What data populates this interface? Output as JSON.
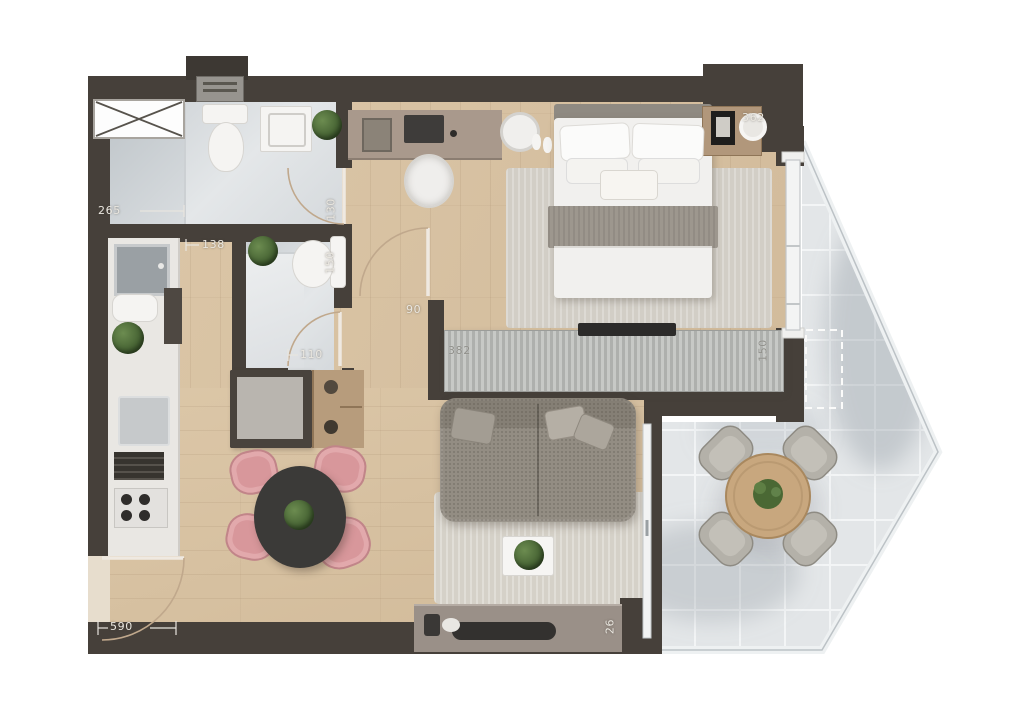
{
  "plan": {
    "dimensions": {
      "bath1_width_cm": "265",
      "bath1_wall_cm": "130",
      "bath2_height_cm": "150",
      "hall_width_cm": "138",
      "bath2_door_cm": "110",
      "bedroom_opening_cm": "90",
      "divider_length_cm": "382",
      "divider_end_cm": "150",
      "bedroom_width_cm": "362",
      "living_length_cm": "590",
      "sideboard_cm": "26"
    },
    "colors": {
      "wall": "#46403a",
      "wood_floor": "#d8c2a3",
      "bath_tile": "#d6dadd",
      "balcony_tile": "#e3e6e8",
      "sofa": "#938d83",
      "dining_chair_pink": "#d8979b",
      "dining_table": "#3b3a38",
      "balcony_table_wood": "#c8a77e",
      "rug": "#d3cfc6",
      "counter": "#e9e7e3",
      "desk": "#a9998c",
      "dimension_text": "#eae7e0"
    }
  }
}
